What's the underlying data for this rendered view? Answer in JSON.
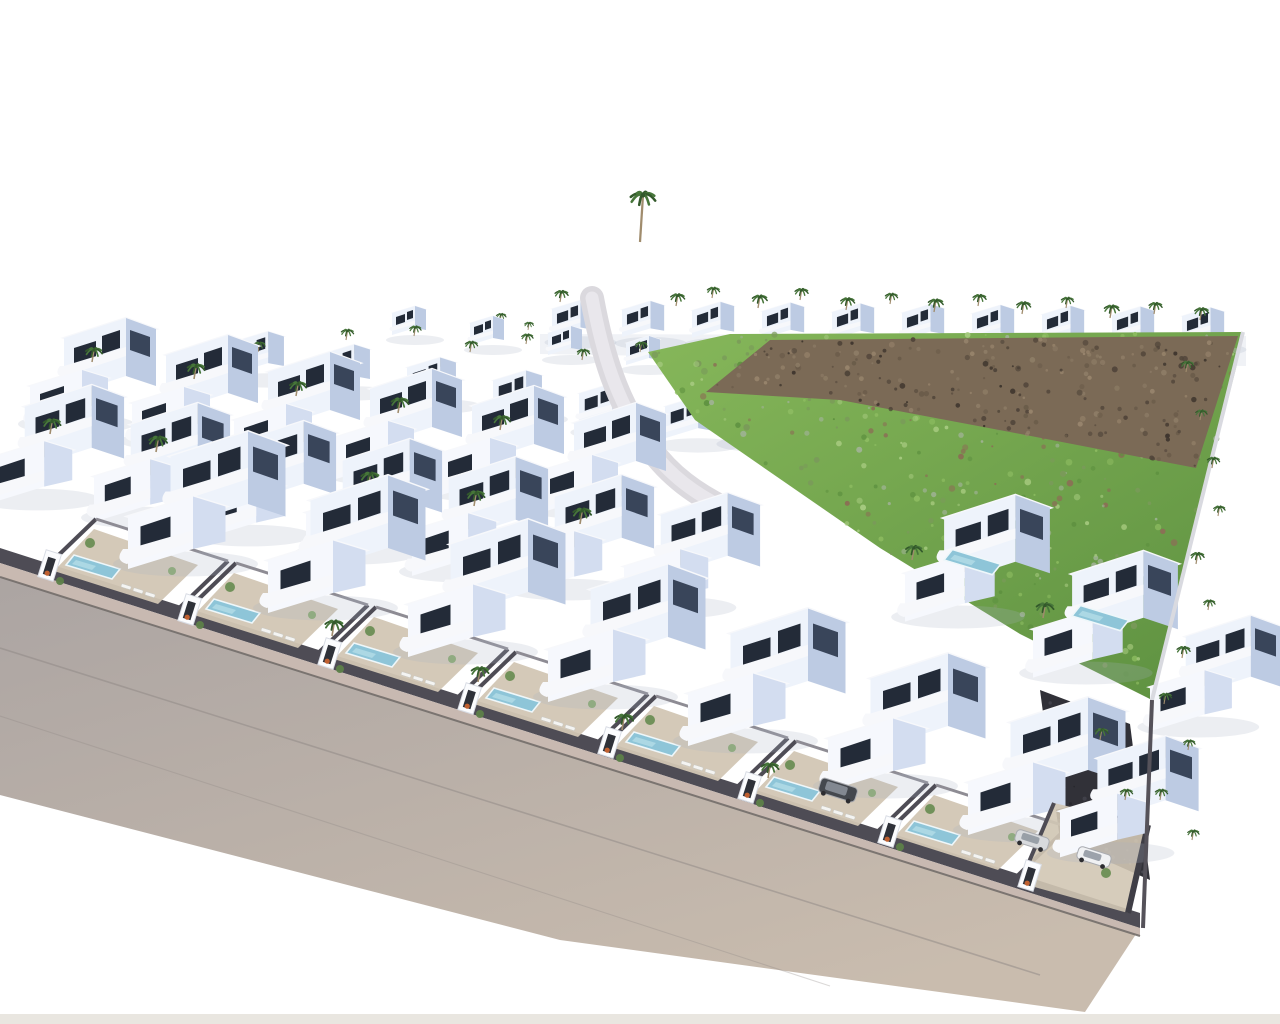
{
  "meta": {
    "description": "Aerial 3D architectural rendering of a hillside development: rows of white modern villas with private pools and palm trees, a green undeveloped hillside with brown rocky outcrops on the right, and a wide grey road curving along the lower-left boundary on a white background.",
    "canvas": {
      "w": 1280,
      "h": 1024
    }
  },
  "counts": {
    "villa_rows": 8,
    "front_plots_with_pools": 9,
    "palm_trees": 58,
    "cars": 3,
    "pools": 9
  },
  "palette": {
    "bg": "#ffffff",
    "villaFace": "#eef3fb",
    "villaFaceBright": "#f6f8fd",
    "villaSide": "#bdcbe3",
    "villaShade": "#d3ddf0",
    "roof": "#cfc5ae",
    "roofEdge": "#f7f8fb",
    "window": "#232b38",
    "roadHi": "#aba4a2",
    "roadLo": "#c9bcae",
    "sidewalk": "#c8b9b1",
    "curb": "#6f6a67",
    "seam": "#8f8885",
    "wall": "#4e4c55",
    "wallLight": "#8e8c94",
    "hill1": "#86b75a",
    "hill2": "#5d9040",
    "rock": "#7b6a56",
    "rockDark": "#51453a",
    "rockHi": "#97846c",
    "pool": "#8ec5d8",
    "poolRim": "#eef7fa",
    "palm1": "#47763a",
    "palm2": "#33592b",
    "trunk": "#a08c6d",
    "terrace": "#d2c6b4",
    "gravelDark": "#313138",
    "gravelFleck": "#4a4a54",
    "bush1": "#6c8e54",
    "bush2": "#86a86a",
    "bush3": "#5d7f49",
    "accessRoad": "#dbd9de",
    "accessRoadCenter": "#e9e7ec",
    "carBodyDark": "#44484e",
    "carSilver": "#d8dadd",
    "carWhite": "#f0f1f3",
    "planter": "#c06030",
    "bottomStrip": "#e9e6e0",
    "shadow": "#a8b1c4"
  },
  "scene": {
    "elements": [
      {
        "type": "polygon",
        "name": "ridge-terrace-wall",
        "pts": [
          [
            540,
            334
          ],
          [
            1246,
            336
          ],
          [
            1246,
            366
          ],
          [
            540,
            354
          ]
        ],
        "fill": "#f0f2f6"
      },
      {
        "type": "villaRow",
        "name": "ridge-villa-row",
        "x": 552,
        "y": 330,
        "dx": 70,
        "dy": 0.8,
        "count": 10,
        "scale": 0.62,
        "variant": "small"
      },
      {
        "type": "palms",
        "name": "ridge-palm-trees",
        "items": [
          [
            560,
            302,
            0.8
          ],
          [
            594,
            314,
            0.7
          ],
          [
            640,
            242,
            1.5
          ],
          [
            676,
            306,
            0.85
          ],
          [
            712,
            298,
            0.75
          ],
          [
            758,
            308,
            0.9
          ],
          [
            800,
            300,
            0.8
          ],
          [
            846,
            310,
            0.85
          ],
          [
            890,
            304,
            0.75
          ],
          [
            934,
            312,
            0.9
          ],
          [
            978,
            306,
            0.8
          ],
          [
            1022,
            314,
            0.85
          ],
          [
            1066,
            308,
            0.75
          ],
          [
            1110,
            318,
            0.9
          ],
          [
            1154,
            314,
            0.8
          ],
          [
            1200,
            320,
            0.85
          ],
          [
            500,
            322,
            0.6
          ],
          [
            528,
            330,
            0.55
          ]
        ]
      },
      {
        "type": "villaRow",
        "name": "back-cluster-row",
        "x": 392,
        "y": 330,
        "dx": 78,
        "dy": 10,
        "count": 4,
        "scale": 0.5,
        "variant": "small"
      },
      {
        "type": "villaRow",
        "name": "back-villa-row",
        "x": 235,
        "y": 366,
        "dx": 86,
        "dy": 13,
        "count": 6,
        "scale": 0.72,
        "variant": "small"
      },
      {
        "type": "villaRow",
        "name": "upper-mid-villa-row",
        "x": 726,
        "y": 428,
        "dx": 90,
        "dy": 16,
        "count": 3,
        "scale": 0.8,
        "variant": "small"
      },
      {
        "type": "palms",
        "name": "cluster-palm-trees",
        "items": [
          [
            258,
            352,
            0.7
          ],
          [
            346,
            340,
            0.75
          ],
          [
            414,
            336,
            0.7
          ],
          [
            470,
            352,
            0.75
          ],
          [
            526,
            344,
            0.7
          ],
          [
            582,
            360,
            0.75
          ],
          [
            640,
            352,
            0.7
          ],
          [
            692,
            366,
            0.75
          ],
          [
            746,
            378,
            0.8
          ],
          [
            802,
            388,
            0.75
          ],
          [
            858,
            396,
            0.8
          ],
          [
            914,
            404,
            0.75
          ]
        ]
      },
      {
        "type": "polygon",
        "name": "green-hillside",
        "pts": [
          [
            648,
            352
          ],
          [
            730,
            334
          ],
          [
            1243,
            332
          ],
          [
            1236,
            368
          ],
          [
            1152,
            700
          ],
          [
            1020,
            634
          ],
          [
            880,
            548
          ],
          [
            770,
            472
          ],
          [
            695,
            420
          ]
        ],
        "gradient": "hill"
      },
      {
        "type": "speckles",
        "name": "hillside-vegetation",
        "region": [
          [
            648,
            352
          ],
          [
            730,
            334
          ],
          [
            1243,
            332
          ],
          [
            1236,
            368
          ],
          [
            1152,
            700
          ],
          [
            1020,
            634
          ],
          [
            880,
            548
          ],
          [
            770,
            472
          ],
          [
            695,
            420
          ]
        ],
        "n": 420,
        "seed": 7,
        "rmin": 1,
        "rmax": 3.4,
        "colors": [
          "#5e9140",
          "#8cbb60",
          "#a5c97e",
          "#9fb294",
          "#7a9a5a",
          "#8a7055"
        ]
      },
      {
        "type": "polygon",
        "name": "rocky-outcrop",
        "pts": [
          [
            706,
            392
          ],
          [
            770,
            340
          ],
          [
            1238,
            336
          ],
          [
            1196,
            468
          ],
          [
            1010,
            432
          ],
          [
            840,
            400
          ]
        ],
        "fill": "#7b6a56"
      },
      {
        "type": "speckles",
        "name": "rocky-outcrop-texture",
        "region": [
          [
            706,
            392
          ],
          [
            770,
            340
          ],
          [
            1238,
            336
          ],
          [
            1196,
            468
          ],
          [
            1010,
            432
          ],
          [
            840,
            400
          ]
        ],
        "n": 240,
        "seed": 11,
        "rmin": 1,
        "rmax": 3,
        "colors": [
          "#51453a",
          "#6b5c4a",
          "#8d7c66",
          "#97846c",
          "#3f362e"
        ]
      },
      {
        "type": "path",
        "name": "access-road",
        "d": "M 592,298 C 602,352 616,402 650,448 C 670,476 696,494 724,508",
        "stroke": "#dbd9de",
        "w": 24
      },
      {
        "type": "path",
        "name": "access-road-center",
        "d": "M 592,298 C 602,352 616,402 650,448 C 670,476 696,494 724,508",
        "stroke": "#e9e7ec",
        "w": 13
      },
      {
        "type": "villaRow",
        "name": "mid-villa-row-1",
        "x": 30,
        "y": 404,
        "dx": 102,
        "dy": 17,
        "count": 6,
        "scale": 1.0,
        "variant": "full"
      },
      {
        "type": "palms",
        "name": "grid-palm-trees-1",
        "items": [
          [
            92,
            362,
            1.0
          ],
          [
            194,
            379,
            1.05
          ],
          [
            296,
            396,
            1.0
          ],
          [
            398,
            413,
            1.05
          ],
          [
            500,
            430,
            1.0
          ]
        ]
      },
      {
        "type": "villaRow",
        "name": "mid-villa-row-2",
        "x": -12,
        "y": 478,
        "dx": 106,
        "dy": 18,
        "count": 7,
        "scale": 1.08,
        "variant": "full"
      },
      {
        "type": "palms",
        "name": "grid-palm-trees-2",
        "items": [
          [
            50,
            434,
            1.05
          ],
          [
            156,
            452,
            1.1
          ],
          [
            262,
            470,
            1.05
          ],
          [
            368,
            488,
            1.1
          ],
          [
            474,
            506,
            1.05
          ],
          [
            580,
            524,
            1.1
          ]
        ]
      },
      {
        "type": "polygon",
        "name": "road",
        "pts": [
          [
            0,
            565
          ],
          [
            1140,
            928
          ],
          [
            1085,
            1012
          ],
          [
            560,
            940
          ],
          [
            0,
            795
          ]
        ],
        "gradient": "road"
      },
      {
        "type": "line",
        "name": "road-seam-1",
        "x1": 0,
        "y1": 648,
        "x2": 1040,
        "y2": 975,
        "stroke": "#8f8885",
        "w": 1.6,
        "op": 0.5
      },
      {
        "type": "line",
        "name": "road-seam-2",
        "x1": 0,
        "y1": 716,
        "x2": 830,
        "y2": 986,
        "stroke": "#8f8885",
        "w": 1.1,
        "op": 0.32
      },
      {
        "type": "polygon",
        "name": "front-boundary-wall",
        "pts": [
          [
            0,
            548
          ],
          [
            1140,
            913
          ],
          [
            1140,
            928
          ],
          [
            0,
            563
          ]
        ],
        "fill": "#4e4c55"
      },
      {
        "type": "polygon",
        "name": "front-sidewalk",
        "pts": [
          [
            0,
            563
          ],
          [
            1140,
            928
          ],
          [
            1140,
            936
          ],
          [
            0,
            577
          ]
        ],
        "fill": "#c8b9b1"
      },
      {
        "type": "line",
        "name": "curb-line",
        "x1": 0,
        "y1": 577,
        "x2": 1140,
        "y2": 936,
        "stroke": "#6f6a67",
        "w": 2,
        "op": 0.85
      },
      {
        "type": "villas",
        "name": "right-mid-villas",
        "items": [
          [
            905,
            594,
            1.15,
            "full"
          ],
          [
            1033,
            650,
            1.15,
            "full"
          ],
          [
            1150,
            706,
            1.05,
            "full"
          ]
        ]
      },
      {
        "type": "pools",
        "name": "right-mid-pools",
        "items": [
          [
            944,
            560
          ],
          [
            1072,
            616
          ]
        ]
      },
      {
        "type": "polygon",
        "name": "dark-gravel-garden",
        "pts": [
          [
            1040,
            690
          ],
          [
            1130,
            724
          ],
          [
            1150,
            880
          ],
          [
            1060,
            840
          ]
        ],
        "fill": "#313138"
      },
      {
        "type": "speckles",
        "name": "dark-gravel-texture",
        "region": [
          [
            1040,
            690
          ],
          [
            1130,
            724
          ],
          [
            1150,
            880
          ],
          [
            1060,
            840
          ]
        ],
        "n": 90,
        "seed": 23,
        "rmin": 0.8,
        "rmax": 2.2,
        "colors": [
          "#4a4a54",
          "#26262c",
          "#5a5a64"
        ]
      },
      {
        "type": "frontPlots",
        "name": "front-villa-plots",
        "anchors": [
          [
            40,
            573
          ],
          [
            180,
            617
          ],
          [
            320,
            661
          ],
          [
            460,
            706
          ],
          [
            600,
            750
          ],
          [
            740,
            795
          ],
          [
            880,
            839
          ]
        ]
      },
      {
        "type": "cornerPlot",
        "name": "corner-villa-plot",
        "x": 1020,
        "y": 883
      },
      {
        "type": "palms",
        "name": "front-garden-palm-trees",
        "items": [
          [
            332,
            636,
            1.1
          ],
          [
            478,
            682,
            1.05
          ],
          [
            622,
            730,
            1.1
          ],
          [
            768,
            778,
            1.05
          ],
          [
            912,
            560,
            1.0
          ],
          [
            1043,
            618,
            1.05
          ]
        ]
      },
      {
        "type": "polyline",
        "name": "right-boundary-wall-upper",
        "pts": [
          [
            1243,
            332
          ],
          [
            1152,
            700
          ]
        ],
        "stroke": "#d9dae0",
        "w": 4
      },
      {
        "type": "polyline",
        "name": "right-boundary-wall-lower",
        "pts": [
          [
            1152,
            700
          ],
          [
            1143,
            928
          ]
        ],
        "stroke": "#55525a",
        "w": 4
      },
      {
        "type": "palms",
        "name": "boundary-palm-trees",
        "items": [
          [
            1186,
            372,
            0.75
          ],
          [
            1200,
            420,
            0.7
          ],
          [
            1212,
            468,
            0.75
          ],
          [
            1218,
            516,
            0.7
          ],
          [
            1196,
            564,
            0.8
          ],
          [
            1208,
            610,
            0.7
          ],
          [
            1182,
            658,
            0.8
          ],
          [
            1164,
            704,
            0.75
          ],
          [
            1188,
            750,
            0.7
          ],
          [
            1160,
            800,
            0.75
          ],
          [
            1192,
            840,
            0.7
          ],
          [
            1100,
            740,
            0.8
          ],
          [
            1125,
            800,
            0.75
          ]
        ]
      },
      {
        "type": "cars",
        "name": "parked-cars",
        "items": [
          [
            838,
            790,
            "#44484e",
            "suv"
          ],
          [
            1032,
            840,
            "#d8dadd",
            "car"
          ],
          [
            1094,
            857,
            "#f0f1f3",
            "car"
          ]
        ]
      },
      {
        "type": "rect",
        "name": "bottom-edge-strip",
        "x": 0,
        "y": 1014,
        "w": 1280,
        "h": 10,
        "fill": "#e9e6e0"
      }
    ]
  }
}
